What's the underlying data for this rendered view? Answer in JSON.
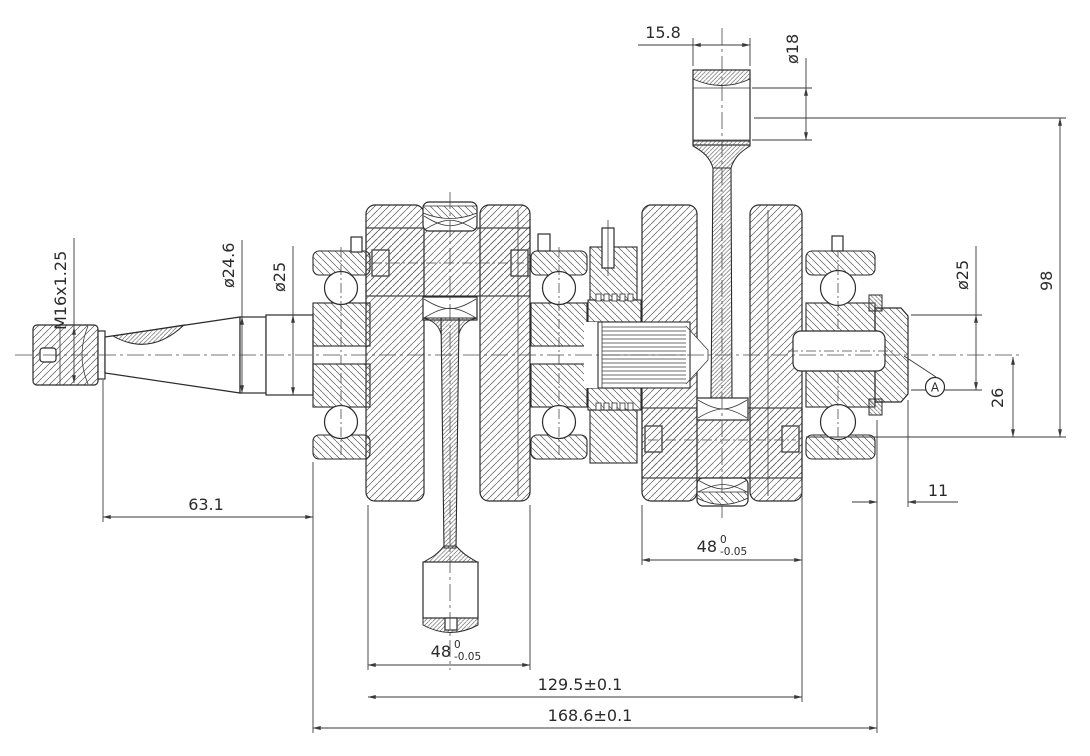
{
  "drawing": {
    "dimensions": {
      "thread_spec": "M16x1.25",
      "taper_major_dia": "ø24.6",
      "left_journal_dia": "ø25",
      "taper_length": "63.1",
      "rod_small_end_width": "15.8",
      "pin_bore_dia": "ø18",
      "right_journal_dia": "ø25",
      "overall_throw": "98",
      "pin_offset": "26",
      "end_stub_length": "11",
      "left_crank_width": {
        "nominal": "48",
        "upper_tol": "0",
        "lower_tol": "-0.05"
      },
      "right_crank_width": {
        "nominal": "48",
        "upper_tol": "0",
        "lower_tol": "-0.05"
      },
      "mid_span": "129.5±0.1",
      "overall_span": "168.6±0.1"
    },
    "datum": {
      "label": "A"
    },
    "colors": {
      "line": "#2b2b2b",
      "hatch": "#5a5a5a",
      "background": "#ffffff"
    }
  }
}
